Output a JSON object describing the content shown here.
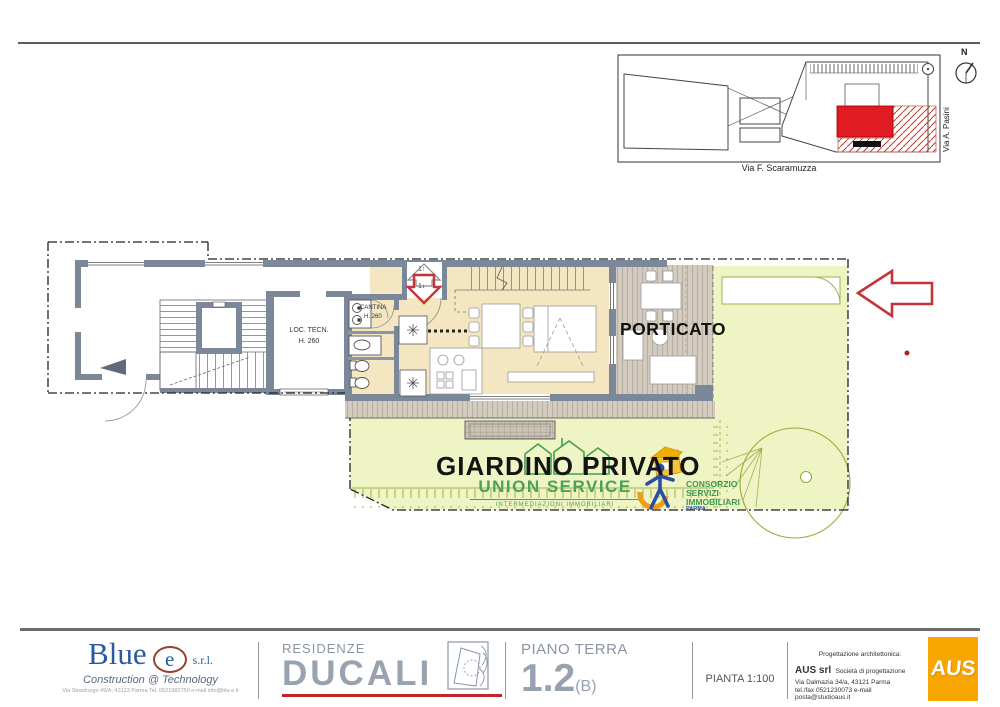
{
  "colors": {
    "wall": "#7a8899",
    "floor": "#f4e6c0",
    "deck": "#d3ccbf",
    "garden": "#eef4c3",
    "olive": "#a3af52",
    "red": "#c4343a",
    "accent_red": "#c0272d",
    "title_gray": "#97a2b0",
    "blue": "#2b5aa0",
    "orange": "#f7a600",
    "union_green": "#4aa254",
    "consorzio_green": "#3c9a4c"
  },
  "site_inset": {
    "street_bottom": "Via F. Scaramuzza",
    "street_right": "Via A. Pasini",
    "compass": "N"
  },
  "plan": {
    "rooms": {
      "loc_tecn_name": "LOC. TECN.",
      "loc_tecn_h": "H. 260",
      "cantina_name": "CANTINA",
      "cantina_h": "H. 260",
      "porticato": "PORTICATO",
      "giardino": "GIARDINO PRIVATO"
    },
    "entrance": {
      "up_num": "1",
      "up_icon": "↑",
      "down_num": "1",
      "down_icon": "↓"
    },
    "watermarks": {
      "union": {
        "title": "UNION SERVICE",
        "subtitle": "INTERMEDIAZIONI IMMOBILIARI",
        "heart_icon": "♥"
      },
      "consorzio": {
        "line1": "CONSORZIO",
        "line2": "SERVIZI",
        "line3": "IMMOBILIARI",
        "line4": "PARMA"
      }
    }
  },
  "titleblock": {
    "blue_e": {
      "word": "Blue",
      "e": "e",
      "srl": "s.r.l.",
      "tagline": "Construction @ Technology",
      "address": "Via Strasburgo 49/A, 43123 Parma Tel. 0521982750 e-mail info@blu-e.it"
    },
    "residenze": {
      "label": "RESIDENZE",
      "name": "DUCALI"
    },
    "floor": {
      "label": "PIANO TERRA",
      "number": "1.2",
      "variant": "(B)"
    },
    "scale_label": "PIANTA 1:100",
    "architect": {
      "line1": "Progettazione architettonica:",
      "name": "AUS srl",
      "role": "Società di progettazione",
      "addr": "Via Dalmazia 34/a, 43121 Parma",
      "contact": "tel./fax 0521230073 e-mail posta@studioaus.it",
      "logo": "AUS"
    }
  }
}
